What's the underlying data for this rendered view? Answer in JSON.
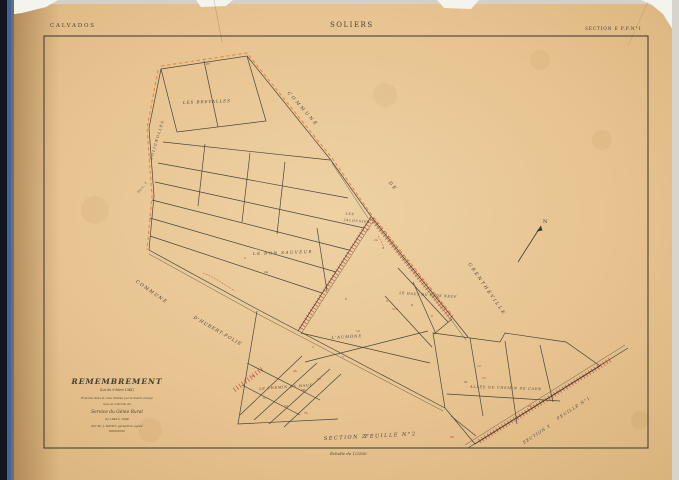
{
  "page": {
    "paper_color": "#e7c390",
    "paper_edge_color": "#d3ab74",
    "binding_dark": "#14161f",
    "binding_blue": "#3f63a0",
    "line_color": "#4a443a",
    "red_road_color": "#bf4636",
    "orange_lisere_color": "#e2813c"
  },
  "header": {
    "department": "CALVADOS",
    "commune": "SOLIERS",
    "section": "SECTION E   P.P.N°1"
  },
  "title_block": {
    "title": "REMEMBREMENT",
    "law": "(Loi du 9 Mars 1941)",
    "line1": "Exécuté dans la zone limitée par le liséré orange",
    "line2": "sous le contrôle du",
    "line3": "Service du Génie Rural",
    "line4": "de 1946 à 1948",
    "line5": "Par M. J. NICET, géomètre agréé"
  },
  "footer": {
    "section_left": "SECTION Z",
    "sheet_left": "FEUILLE N°2",
    "scale": "Échelle de 1/2500",
    "section_right": "SECTION Y",
    "sheet_right": "FEUILLE N°1"
  },
  "compass": {
    "label": "N"
  },
  "map_labels": [
    {
      "name": "label-les-brevalles",
      "text": "LES BREVALLES",
      "x": 207,
      "y": 103,
      "rot": -2,
      "size": 4,
      "ls": 1
    },
    {
      "name": "label-commune-grentheville-1",
      "text": "COMMUNE",
      "x": 302,
      "y": 110,
      "rot": 49,
      "size": 4.5,
      "ls": 2.5
    },
    {
      "name": "label-commune-grentheville-2",
      "text": "DE",
      "x": 392,
      "y": 187,
      "rot": 49,
      "size": 4.5,
      "ls": 2
    },
    {
      "name": "label-commune-grentheville-3",
      "text": "GRENTHEVILLE",
      "x": 486,
      "y": 290,
      "rot": 55,
      "size": 4.5,
      "ls": 2
    },
    {
      "name": "label-solignolles",
      "text": "SOLIGNOLLES",
      "x": 158,
      "y": 140,
      "rot": -73,
      "size": 3.6,
      "ls": 1.2
    },
    {
      "name": "label-sect-y-left",
      "text": "Sect. Y",
      "x": 143,
      "y": 188,
      "rot": -50,
      "size": 3,
      "ls": 0.5
    },
    {
      "name": "label-les-jalousies-1",
      "text": "LES",
      "x": 350,
      "y": 215,
      "rot": 5,
      "size": 3.2,
      "ls": 0.8
    },
    {
      "name": "label-les-jalousies-2",
      "text": "JALOUSIES",
      "x": 357,
      "y": 222,
      "rot": 5,
      "size": 3.2,
      "ls": 0.8
    },
    {
      "name": "label-le-bon-sauveur",
      "text": "LE BON SAUVEUR",
      "x": 283,
      "y": 254,
      "rot": -2,
      "size": 4,
      "ls": 1.5
    },
    {
      "name": "label-le-haut-du-clos-neuf",
      "text": "LE HAUT DU CLOS NEUF",
      "x": 428,
      "y": 296,
      "rot": 4,
      "size": 3.4,
      "ls": 0.6
    },
    {
      "name": "label-l-aumone",
      "text": "L'AUMÔNE",
      "x": 347,
      "y": 338,
      "rot": -3,
      "size": 3.8,
      "ls": 1
    },
    {
      "name": "label-le-chemin-du-haut",
      "text": "LE CHEMIN DU HAUT",
      "x": 286,
      "y": 388,
      "rot": -4,
      "size": 3.4,
      "ls": 0.8
    },
    {
      "name": "label-allee-du-chemin-de-caen",
      "text": "ALLÉE DU CHEMIN DE CAEN",
      "x": 506,
      "y": 389,
      "rot": 2,
      "size": 3.4,
      "ls": 0.8
    },
    {
      "name": "label-commune-hubert-folie-1",
      "text": "COMMUNE",
      "x": 151,
      "y": 293,
      "rot": 35,
      "size": 4.5,
      "ls": 1.5
    },
    {
      "name": "label-commune-hubert-folie-2",
      "text": "D'HUBERT-FOLIE",
      "x": 217,
      "y": 332,
      "rot": 30,
      "size": 4.5,
      "ls": 1
    }
  ],
  "parcel_numbers": [
    {
      "t": "27",
      "x": 366,
      "y": 231,
      "c": "r"
    },
    {
      "t": "24",
      "x": 374,
      "y": 241,
      "c": "r"
    },
    {
      "t": "9",
      "x": 382,
      "y": 249,
      "c": "r"
    },
    {
      "t": "2",
      "x": 244,
      "y": 259,
      "c": "r"
    },
    {
      "t": "9",
      "x": 386,
      "y": 302,
      "c": "r"
    },
    {
      "t": "112",
      "x": 392,
      "y": 310,
      "c": "r"
    },
    {
      "t": "8",
      "x": 431,
      "y": 317,
      "c": "r"
    },
    {
      "t": "14",
      "x": 356,
      "y": 332,
      "c": "r"
    },
    {
      "t": "3",
      "x": 312,
      "y": 348,
      "c": "r"
    },
    {
      "t": "7",
      "x": 342,
      "y": 358,
      "c": "r"
    },
    {
      "t": "49",
      "x": 251,
      "y": 377,
      "c": "r"
    },
    {
      "t": "46",
      "x": 293,
      "y": 372,
      "c": "r"
    },
    {
      "t": "23",
      "x": 317,
      "y": 380,
      "c": "r"
    },
    {
      "t": "51",
      "x": 263,
      "y": 399,
      "c": "r"
    },
    {
      "t": "53",
      "x": 284,
      "y": 407,
      "c": "r"
    },
    {
      "t": "55",
      "x": 304,
      "y": 414,
      "c": "r"
    },
    {
      "t": "12",
      "x": 477,
      "y": 367,
      "c": "r"
    },
    {
      "t": "72",
      "x": 482,
      "y": 379,
      "c": "r"
    },
    {
      "t": "26",
      "x": 528,
      "y": 407,
      "c": "r"
    },
    {
      "t": "26",
      "x": 450,
      "y": 438,
      "c": "r"
    },
    {
      "t": "27",
      "x": 206,
      "y": 65,
      "c": "k"
    },
    {
      "t": "14",
      "x": 264,
      "y": 273,
      "c": "k"
    },
    {
      "t": "9",
      "x": 411,
      "y": 306,
      "c": "k"
    },
    {
      "t": "21",
      "x": 464,
      "y": 383,
      "c": "k"
    },
    {
      "t": "18",
      "x": 301,
      "y": 391,
      "c": "k"
    },
    {
      "t": "5",
      "x": 345,
      "y": 300,
      "c": "k"
    }
  ]
}
